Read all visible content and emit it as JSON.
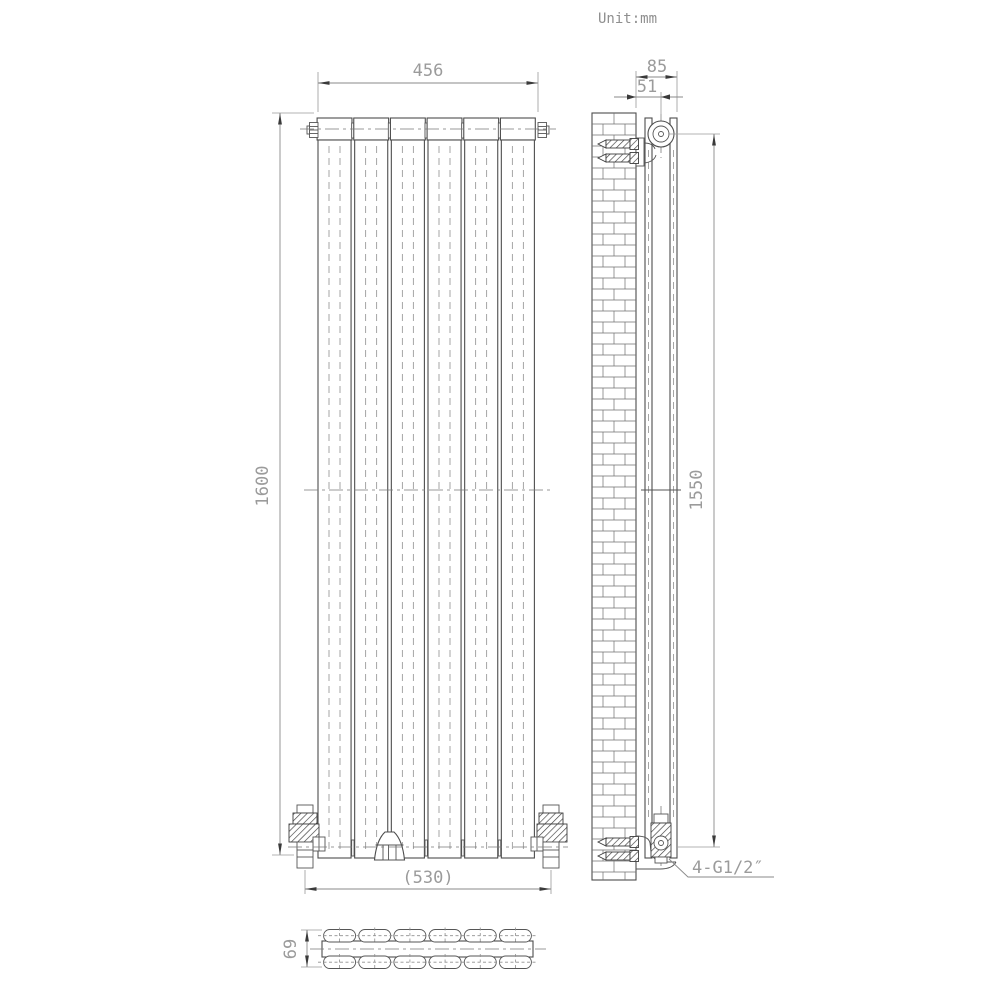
{
  "unit": {
    "label": "Unit:mm"
  },
  "dimensions": {
    "overall_width": "456",
    "overall_height": "1600",
    "wall_to_front": "85",
    "wall_to_pipe_centre": "51",
    "inlet_height": "1550",
    "valve_centres": "(530)",
    "section_depth": "69",
    "connection_thread": "4-G1/2″"
  },
  "drawing": {
    "front_panel_count": 6,
    "section_tube_columns": 6,
    "section_tube_rows": 2
  }
}
